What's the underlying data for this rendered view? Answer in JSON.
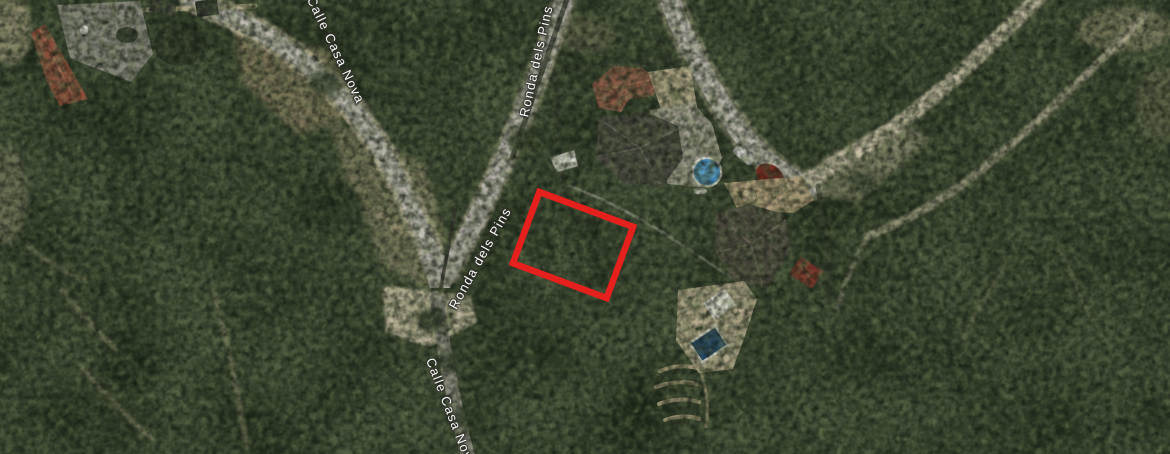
{
  "map": {
    "road_labels": [
      {
        "id": "calle-casa-nova-upper",
        "text": "Calle Casa Nova"
      },
      {
        "id": "ronda-dels-pins-upper",
        "text": "Ronda dels Pins"
      },
      {
        "id": "ronda-dels-pins-lower",
        "text": "Ronda dels Pins"
      },
      {
        "id": "calle-casa-nova-lower",
        "text": "Calle Casa Nova"
      }
    ],
    "parcel_highlight": {
      "stroke_color": "#e6201c"
    },
    "imagery": {
      "scene": "aerial-satellite",
      "features": [
        "forest",
        "roads",
        "dirt-paths",
        "houses",
        "round-pool",
        "rect-pool",
        "cars",
        "highlighted-parcel"
      ]
    }
  }
}
